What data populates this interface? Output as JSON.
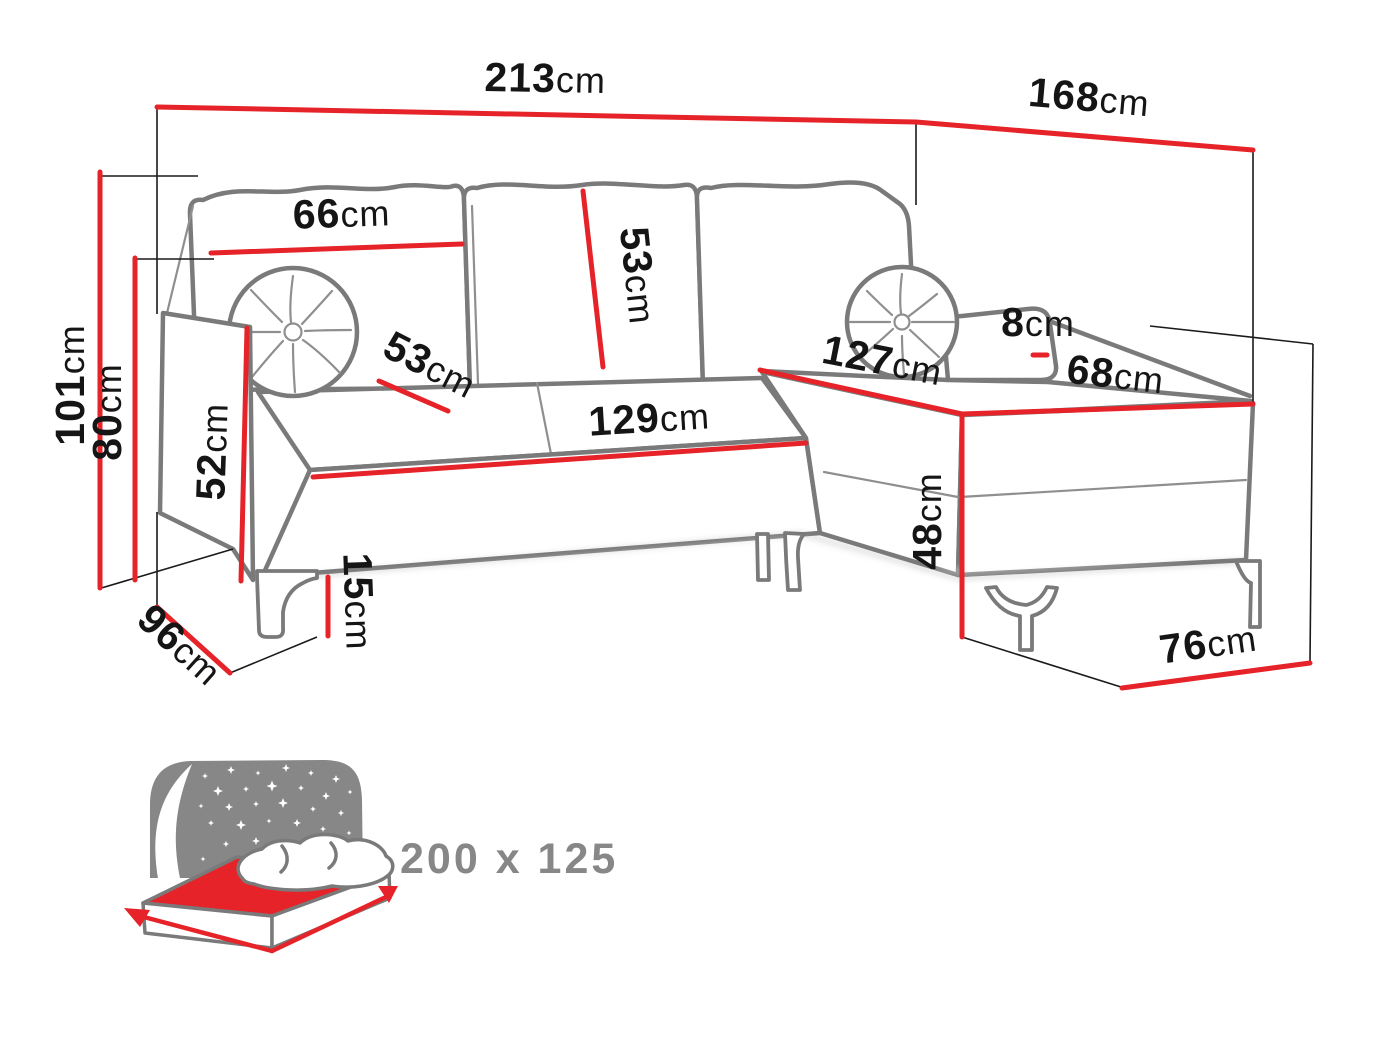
{
  "colors": {
    "dimension_red": "#e52328",
    "sketch_grey": "#7a7a7a",
    "icon_grey": "#878787",
    "label_black": "#151515"
  },
  "dims": {
    "total_width": {
      "v": "213",
      "u": "cm"
    },
    "total_depth": {
      "v": "168",
      "u": "cm"
    },
    "total_height": {
      "v": "101",
      "u": "cm"
    },
    "backrest_height": {
      "v": "80",
      "u": "cm"
    },
    "armrest_height": {
      "v": "52",
      "u": "cm"
    },
    "back_cushion_width": {
      "v": "66",
      "u": "cm"
    },
    "back_cushion_height": {
      "v": "53",
      "u": "cm"
    },
    "seat_depth": {
      "v": "53",
      "u": "cm"
    },
    "seat_width": {
      "v": "129",
      "u": "cm"
    },
    "chaise_length": {
      "v": "127",
      "u": "cm"
    },
    "armrest_pad_height": {
      "v": "8",
      "u": "cm"
    },
    "chaise_width": {
      "v": "68",
      "u": "cm"
    },
    "base_height": {
      "v": "48",
      "u": "cm"
    },
    "leg_height": {
      "v": "15",
      "u": "cm"
    },
    "side_depth": {
      "v": "96",
      "u": "cm"
    },
    "chaise_end_width": {
      "v": "76",
      "u": "cm"
    }
  },
  "sleeping_area": {
    "size_label": "200 x 125"
  }
}
